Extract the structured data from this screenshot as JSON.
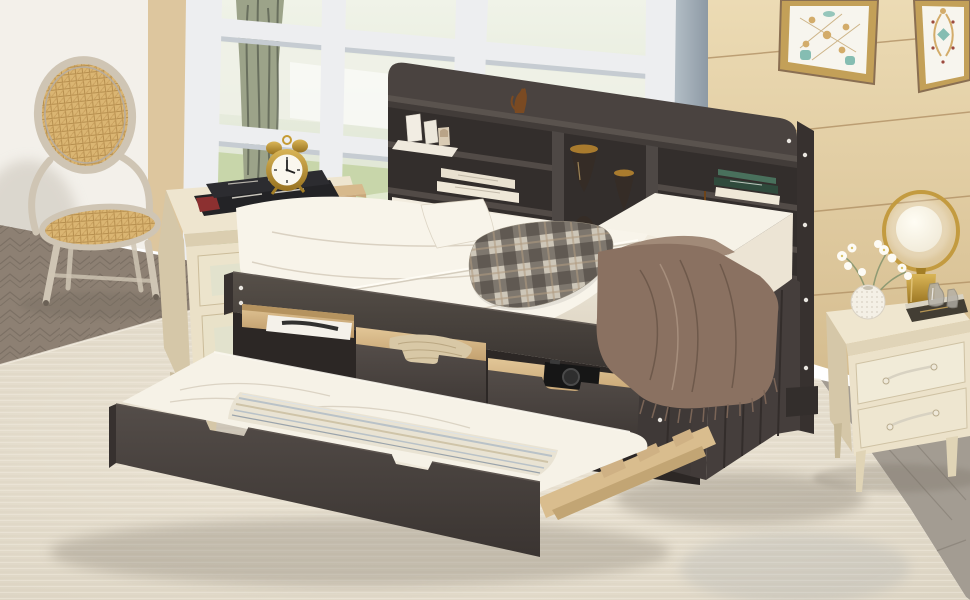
{
  "meta": {
    "kind": "product-photo",
    "description": "Staged bedroom photo of an espresso wood daybed with a bookcase storage headboard, three pull-out storage drawers and a roll-out trundle bed, flanked by a rattan armchair and two cream nightstands in front of white-framed windows and a light oak plank wall."
  },
  "palette": {
    "wall_left": "#f3f0ea",
    "wall_panel": "#ddc69e",
    "wall_groove": "#b29266",
    "window_frame": "#edeef0",
    "foliage": "#c8d6aa",
    "foliage_dark": "#aabf8c",
    "tree_trunk": "#9ca389",
    "tree_streak": "#5d6354",
    "floor_herr": "#8d8073",
    "floor_herr_line": "#776c60",
    "floor_plank": "#a39c92",
    "floor_plank_line": "#8b847a",
    "rug_light": "#efe8d9",
    "rug_base": "#e2dbcb",
    "wood_dark": "#4a4340",
    "wood_darker": "#332e2c",
    "wood_mid": "#5a534e",
    "wood_edge": "#37312f",
    "drawer_wood": "#ddc193",
    "drawer_wood_dark": "#b08c5a",
    "slat_wood": "#d9bd8e",
    "mattress": "#f6f2e7",
    "mattress_shade": "#ddd5c4",
    "bedding_white": "#f8f4ea",
    "fold_line": "#d5ccbc",
    "plaid_base": "#cdc6b8",
    "plaid_dark": "#4e4740",
    "plaid_tan": "#b09a80",
    "throw": "#8a7161",
    "throw_dark": "#6b5749",
    "throw_light": "#a18a78",
    "nightstand_cream": "#ebe1c8",
    "nightstand_shade": "#d5c7a8",
    "nightstand_panel": "#e2e2cd",
    "knob_gold": "#c59b33",
    "clock_face": "#faf7ee",
    "book_black": "#232326",
    "book_red": "#8c3030",
    "book_white": "#efe8d8",
    "book_green": "#2f4a3c",
    "book_teal": "#49705c",
    "hour_gold": "#a97b2e",
    "hour_glass": "#362c26",
    "boat_wood": "#8a5a2c",
    "lamp_gold": "#c39b40",
    "frame_gold": "#c3a058",
    "art_bg": "#f7f5ee",
    "art_teal": "#85bdb2",
    "art_tan": "#d3ac6a",
    "art_red": "#9c4a3e",
    "pin": "#e9e6e0",
    "shadow": "#6f675c",
    "box_tan": "#c9a87c",
    "knit": "#d8c8a6",
    "knit_line": "#b7a47f",
    "camera": "#161616",
    "glass_bottle": "#b3afa6",
    "stripe_blue": "#b9c2c8",
    "stripe_tan": "#cfc4a8",
    "chair_frame": "#cfc5b4",
    "cane": "#dab572"
  },
  "scene": {
    "room": {
      "wall_left": "white painted side wall",
      "accent_panel": "tan wood panel",
      "windows": "white framed windows with tree and pale greenery outside",
      "wall_back": "light oak plank wall with grooves",
      "artworks": [
        "framed tile-motif print",
        "framed ornamental scroll print"
      ],
      "floor": "gray-brown herringbone wood floor",
      "rug": "cream textured area rug"
    },
    "furniture": {
      "rattan_chair": "washed-wood armchair with oval cane back and cane seat",
      "nightstand_left": [
        "stack of black books",
        "gold twin-bell alarm clock",
        "tan box"
      ],
      "daybed": {
        "finish": "espresso",
        "headboard_shelf_items": [
          "white mini boxes on tray",
          "two cream books",
          "two gold-capped hourglasses",
          "stack of green books",
          "wooden boat on books",
          "small cat figurine"
        ],
        "bedding": [
          "white rumpled duvet",
          "white pillow",
          "buffalo plaid pillow",
          "brown fringed throw"
        ],
        "drawer_contents": [
          "white garment box with black print",
          "knitted blanket",
          "black camera"
        ]
      },
      "trundle": [
        "white mattress",
        "striped blanket",
        "espresso front board with cut-out handles",
        "light wood slat frame"
      ],
      "nightstand_right": [
        "gold ring lamp with glowing globe",
        "white flowers in round textured vase",
        "two smoked glass bottles",
        "dark book"
      ]
    }
  }
}
